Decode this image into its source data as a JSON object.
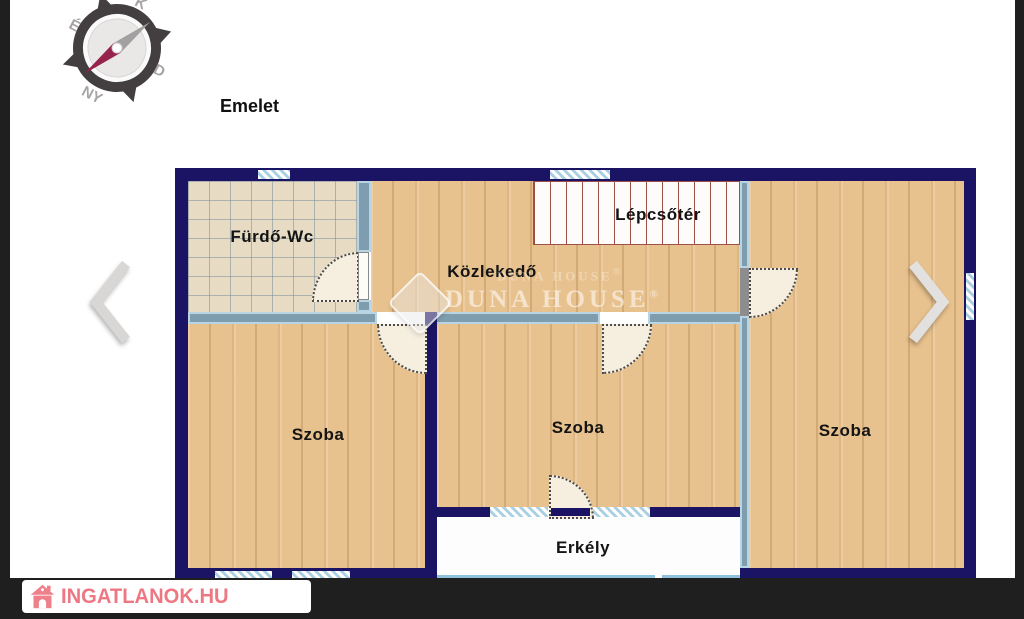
{
  "page": {
    "title_label": "Emelet"
  },
  "compass": {
    "top": "K",
    "right": "D",
    "bottom": "NY",
    "left": "É"
  },
  "navigation": {
    "prev_label": "previous-photo",
    "next_label": "next-photo"
  },
  "floor_plan": {
    "rooms": [
      {
        "id": "furdo-wc",
        "label": "Fürdő-Wc"
      },
      {
        "id": "kozlekedo",
        "label": "Közlekedő"
      },
      {
        "id": "lepcsoter",
        "label": "Lépcsőtér"
      },
      {
        "id": "szoba-left",
        "label": "Szoba"
      },
      {
        "id": "szoba-middle",
        "label": "Szoba"
      },
      {
        "id": "szoba-right",
        "label": "Szoba"
      },
      {
        "id": "erkely",
        "label": "Erkély"
      }
    ],
    "colors": {
      "outer_wall": "#1b1464",
      "interior_wall": "#7e9dae",
      "window": "#a9cfe3",
      "wood_floor": "#e8c28e",
      "tile_floor": "#e7dcc3",
      "stair_line": "#9e5047",
      "railing": "#8fc1dd"
    }
  },
  "watermark": {
    "line_faint": "DUNA HOUSE",
    "line_main": "DUNA HOUSE",
    "registered": "®"
  },
  "branding": {
    "site": "INGATLANOK.HU",
    "accent": "#e95664"
  }
}
